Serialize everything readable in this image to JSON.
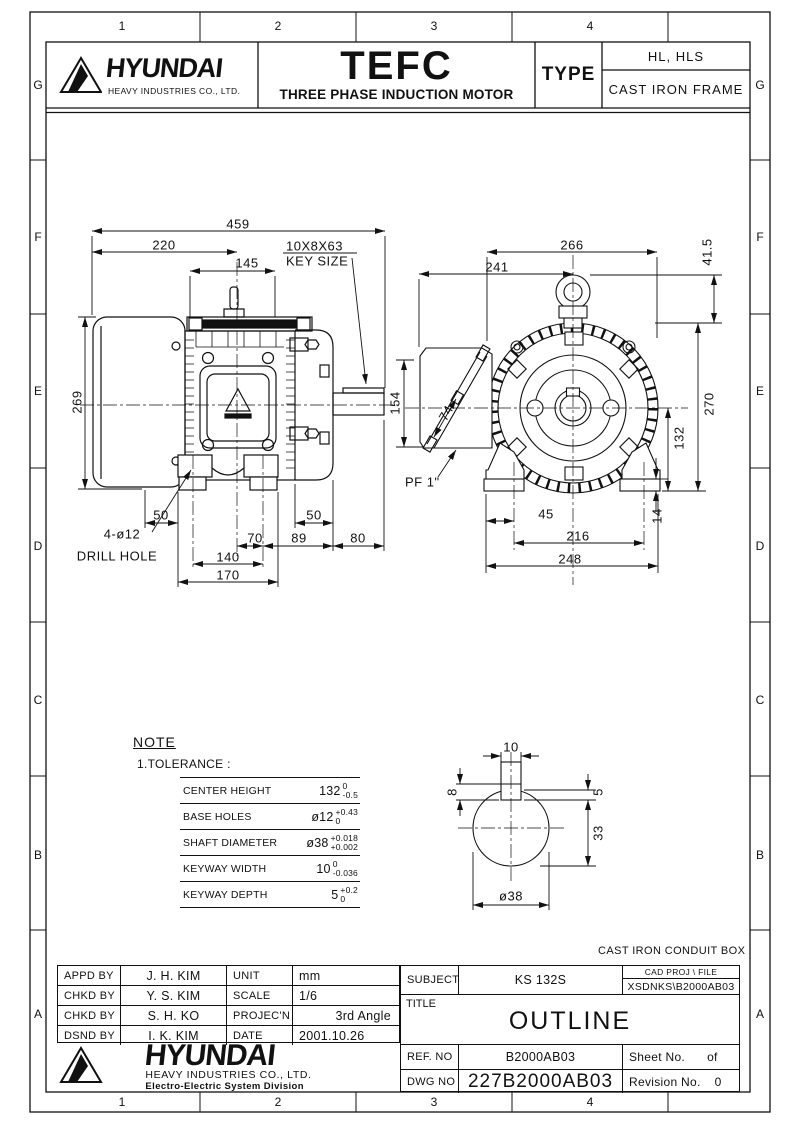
{
  "grid": {
    "cols": [
      "1",
      "2",
      "3",
      "4"
    ],
    "rows": [
      "G",
      "F",
      "E",
      "D",
      "C",
      "B",
      "A"
    ]
  },
  "header": {
    "brand": "HYUNDAI",
    "brand_sub": "HEAVY INDUSTRIES CO., LTD.",
    "product": "TEFC",
    "product_sub": "THREE PHASE INDUCTION MOTOR",
    "type_label": "TYPE",
    "type_row1": "HL, HLS",
    "type_row2": "CAST IRON FRAME"
  },
  "side_view": {
    "overall_length": "459",
    "fan_to_center": "220",
    "top_width": "145",
    "key_size_value": "10X8X63",
    "key_size_label": "KEY SIZE",
    "height": "269",
    "conduit_height": "154",
    "foot_left": "50",
    "foot_right": "50",
    "center_to_hole": "70",
    "hole_to_bracket": "89",
    "shaft_length": "80",
    "hole_span": "140",
    "foot_span": "170",
    "drill_qty": "4-ø12",
    "drill_label": "DRILL HOLE"
  },
  "front_view": {
    "body_width": "266",
    "conduit_to_center": "241",
    "eyebolt_height": "41.5",
    "overall_height": "270",
    "center_height": "132",
    "pad_height": "14",
    "edge_to_hole": "45",
    "hole_span": "216",
    "foot_span": "248",
    "conduit_thread": "PF 1\"",
    "cover_width": "74"
  },
  "shaft_detail": {
    "key_width": "10",
    "key_height": "8",
    "keyway_depth": "5",
    "below_key": "33",
    "diameter": "ø38"
  },
  "note": {
    "heading": "NOTE",
    "item": "1.TOLERANCE :",
    "rows": [
      {
        "label": "CENTER HEIGHT",
        "value": "132",
        "upper": "0",
        "lower": "-0.5"
      },
      {
        "label": "BASE HOLES",
        "value": "ø12",
        "upper": "+0.43",
        "lower": "0"
      },
      {
        "label": "SHAFT DIAMETER",
        "value": "ø38",
        "upper": "+0.018",
        "lower": "+0.002"
      },
      {
        "label": "KEYWAY WIDTH",
        "value": "10",
        "upper": "0",
        "lower": "-0.036"
      },
      {
        "label": "KEYWAY DEPTH",
        "value": "5",
        "upper": "+0.2",
        "lower": "0"
      }
    ]
  },
  "conduit_note": "CAST IRON CONDUIT BOX",
  "title_block": {
    "approvals": [
      {
        "label": "APPD BY",
        "name": "J. H. KIM"
      },
      {
        "label": "CHKD BY",
        "name": "Y. S. KIM"
      },
      {
        "label": "CHKD BY",
        "name": "S. H. KO"
      },
      {
        "label": "DSND BY",
        "name": "I. K. KIM"
      }
    ],
    "meta": [
      {
        "label": "UNIT",
        "value": "mm"
      },
      {
        "label": "SCALE",
        "value": "1/6"
      },
      {
        "label": "PROJEC'N",
        "value": "3rd Angle"
      },
      {
        "label": "DATE",
        "value": "2001.10.26"
      }
    ],
    "subject_label": "SUBJECT",
    "subject": "KS 132S",
    "cad_header": "CAD PROJ    \\ FILE",
    "cad_file": "XSDNKS\\B2000AB03",
    "title_label": "TITLE",
    "title": "OUTLINE",
    "ref_label": "REF. NO",
    "ref_no": "B2000AB03",
    "sheet_label": "Sheet No.",
    "sheet_value": "of",
    "dwg_label": "DWG NO",
    "dwg_no": "227B2000AB03",
    "rev_label": "Revision No.",
    "rev_value": "0",
    "logo_brand": "HYUNDAI",
    "logo_sub1": "HEAVY INDUSTRIES CO., LTD.",
    "logo_sub2": "Electro-Electric System Division"
  }
}
